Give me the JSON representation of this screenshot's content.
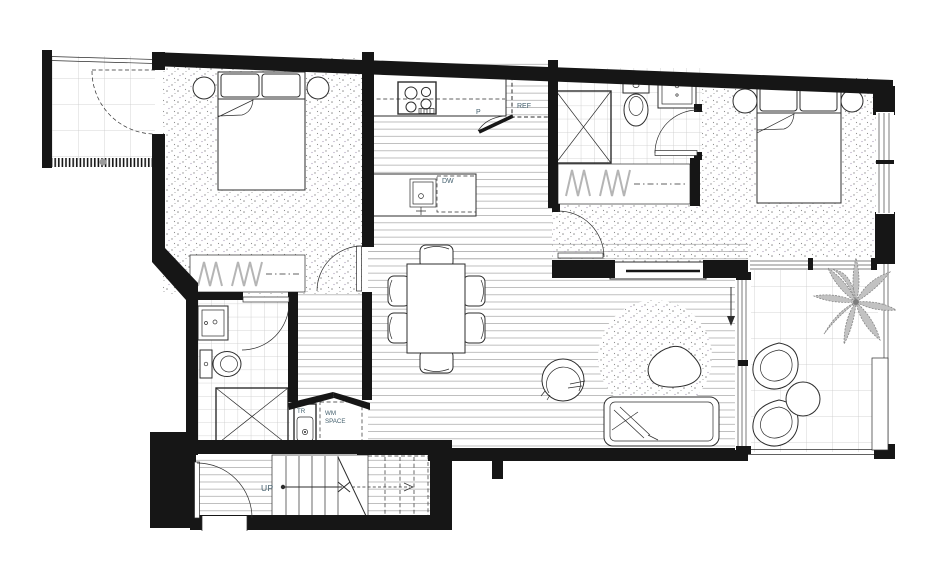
{
  "plan": {
    "labels": {
      "pantry": "P",
      "fridge": "REF",
      "dishwasher": "DW",
      "trough": "TR",
      "wm_line1": "WM",
      "wm_line2": "SPACE",
      "stairs_up": "UP"
    },
    "colors": {
      "wall": "#161616",
      "line": "#2d2d2d",
      "floorline": "#b4b4b4",
      "tile": "#c9c9c9",
      "stipple": "#8f8f8f",
      "glyph": "#b5b5b5",
      "label": "#44606e",
      "plant": "#c2c2c2",
      "plantstroke": "#878787"
    }
  }
}
